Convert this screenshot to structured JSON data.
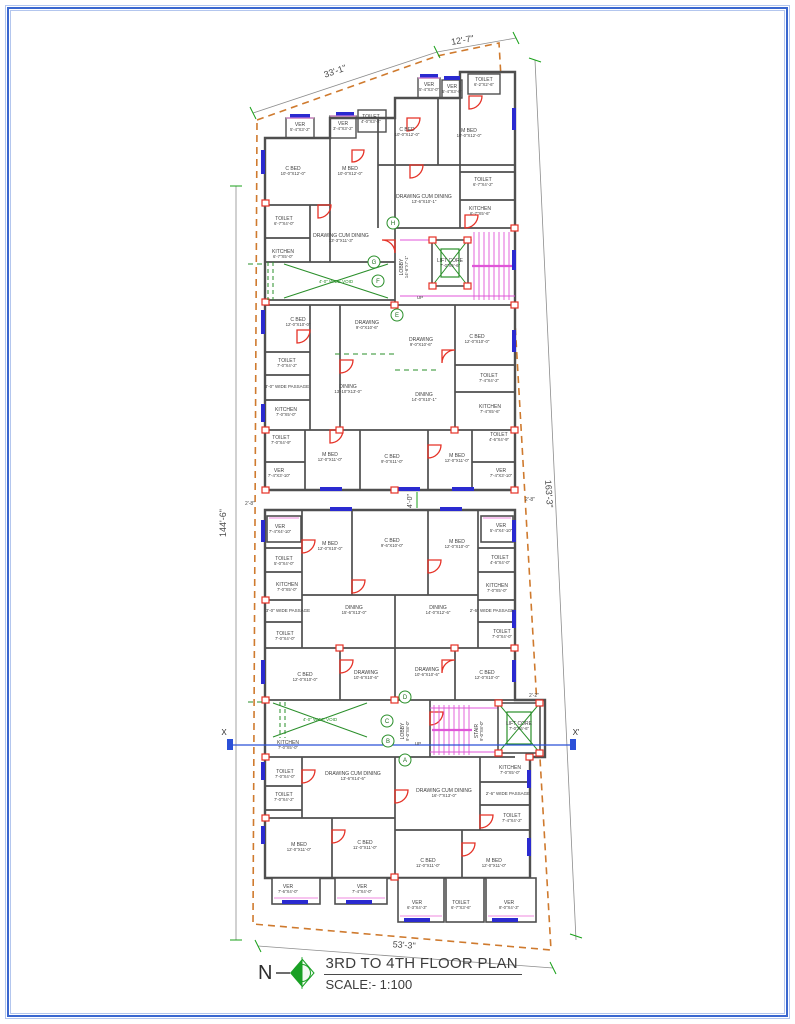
{
  "title_block": {
    "title": "3RD TO 4TH FLOOR PLAN",
    "scale": "SCALE:- 1:100",
    "north_label": "N"
  },
  "section_line": {
    "left_label": "X",
    "right_label": "X'"
  },
  "colors": {
    "border_blue": "#3a67cf",
    "wall_gray": "#4f4f4f",
    "door_red": "#e53126",
    "window_blue": "#2a2ad0",
    "dimension_green": "#18a018",
    "plot_boundary_orange": "#cf7a2e",
    "stair_magenta": "#e055d8",
    "section_blue": "#2b50d8"
  },
  "dim_labels": [
    {
      "label": "33'-1\"",
      "x": 336,
      "y": 74,
      "rot": -19,
      "size": 9
    },
    {
      "label": "12'-7\"",
      "x": 463,
      "y": 43,
      "rot": -10,
      "size": 9
    },
    {
      "label": "144'-6\"",
      "x": 226,
      "y": 523,
      "rot": -90,
      "size": 9
    },
    {
      "label": "163'-3\"",
      "x": 546,
      "y": 494,
      "rot": 86,
      "size": 9
    },
    {
      "label": "53'-3\"",
      "x": 404,
      "y": 948,
      "rot": 4,
      "size": 9
    },
    {
      "label": "4'-0\"",
      "x": 412,
      "y": 501,
      "rot": -90,
      "size": 7
    },
    {
      "label": "2'-8\"",
      "x": 250,
      "y": 505,
      "rot": 0,
      "size": 5
    },
    {
      "label": "2'-8\"",
      "x": 530,
      "y": 501,
      "rot": 0,
      "size": 5
    },
    {
      "label": "2'-2\"",
      "x": 534,
      "y": 697,
      "rot": 0,
      "size": 5
    }
  ],
  "grid_bubbles": [
    {
      "label": "H",
      "x": 393,
      "y": 223
    },
    {
      "label": "G",
      "x": 374,
      "y": 262
    },
    {
      "label": "F",
      "x": 378,
      "y": 281
    },
    {
      "label": "E",
      "x": 397,
      "y": 315
    },
    {
      "label": "D",
      "x": 405,
      "y": 697
    },
    {
      "label": "C",
      "x": 387,
      "y": 721
    },
    {
      "label": "B",
      "x": 388,
      "y": 741
    },
    {
      "label": "A",
      "x": 405,
      "y": 760
    }
  ],
  "rooms": [
    {
      "label": "VER",
      "dims": "5'-4\"X3'-2\"",
      "x": 300,
      "y": 126
    },
    {
      "label": "VER",
      "dims": "3'-4\"X3'-2\"",
      "x": 343,
      "y": 125
    },
    {
      "label": "TOILET",
      "dims": "4'-0\"X3'-2\"",
      "x": 371,
      "y": 118
    },
    {
      "label": "VER",
      "dims": "5'-4\"X3'-0\"",
      "x": 429,
      "y": 86
    },
    {
      "label": "VER",
      "dims": "5'-4\"X3'-0\"",
      "x": 452,
      "y": 88
    },
    {
      "label": "TOILET",
      "dims": "6'-2\"X2'-6\"",
      "x": 484,
      "y": 81
    },
    {
      "label": "C BED",
      "dims": "10'-0\"X12'-0\"",
      "x": 293,
      "y": 170
    },
    {
      "label": "M BED",
      "dims": "10'-0\"X12'-0\"",
      "x": 350,
      "y": 170
    },
    {
      "label": "C BED",
      "dims": "10'-0\"X12'-0\"",
      "x": 407,
      "y": 131
    },
    {
      "label": "M BED",
      "dims": "10'-0\"X12'-0\"",
      "x": 469,
      "y": 132
    },
    {
      "label": "DRAWING CUM DINING",
      "dims": "13'-6\"X10'-1\"",
      "x": 424,
      "y": 198
    },
    {
      "label": "TOILET",
      "dims": "6'-7\"X4'-2\"",
      "x": 483,
      "y": 181
    },
    {
      "label": "KITCHEN",
      "dims": "6'-7\"X5'-6\"",
      "x": 480,
      "y": 210
    },
    {
      "label": "TOILET",
      "dims": "6'-7\"X4'-0\"",
      "x": 284,
      "y": 220
    },
    {
      "label": "DRAWING CUM DINING",
      "dims": "13'-3\"X11'-3\"",
      "x": 341,
      "y": 237
    },
    {
      "label": "KITCHEN",
      "dims": "6'-7\"X5'-0\"",
      "x": 283,
      "y": 253
    },
    {
      "label": "4'-0\" WIDE VOID",
      "x": 336,
      "y": 283,
      "color": "#2a8f2a",
      "size": 4.5
    },
    {
      "label": "LOBBY",
      "dims": "14'-6\"X7'-1\"",
      "x": 403,
      "y": 267,
      "rot": -90
    },
    {
      "label": "LIFT CORE",
      "dims": "7'-0\"X6'-6\"",
      "x": 450,
      "y": 262
    },
    {
      "label": "UP",
      "x": 420,
      "y": 299,
      "size": 4.5
    },
    {
      "label": "C BED",
      "dims": "12'-0\"X10'-0\"",
      "x": 298,
      "y": 321
    },
    {
      "label": "DRAWING",
      "dims": "9'-0\"X10'-6\"",
      "x": 367,
      "y": 324
    },
    {
      "label": "DRAWING",
      "dims": "9'-0\"X10'-6\"",
      "x": 421,
      "y": 341
    },
    {
      "label": "C BED",
      "dims": "12'-0\"X10'-0\"",
      "x": 477,
      "y": 338
    },
    {
      "label": "TOILET",
      "dims": "7'-0\"X4'-2\"",
      "x": 287,
      "y": 362
    },
    {
      "label": "3'-0\" WIDE PASSAGE",
      "x": 287,
      "y": 388,
      "size": 4.5
    },
    {
      "label": "DINING",
      "dims": "13'-10\"X13'-0\"",
      "x": 348,
      "y": 388
    },
    {
      "label": "DINING",
      "dims": "14'-0\"X10'-1\"",
      "x": 424,
      "y": 396
    },
    {
      "label": "TOILET",
      "dims": "7'-4\"X4'-2\"",
      "x": 489,
      "y": 377
    },
    {
      "label": "KITCHEN",
      "dims": "7'-0\"X5'-0\"",
      "x": 286,
      "y": 411
    },
    {
      "label": "KITCHEN",
      "dims": "7'-4\"X5'-6\"",
      "x": 490,
      "y": 408
    },
    {
      "label": "TOILET",
      "dims": "7'-0\"X4'-9\"",
      "x": 281,
      "y": 439
    },
    {
      "label": "TOILET",
      "dims": "4'-6\"X4'-9\"",
      "x": 499,
      "y": 436
    },
    {
      "label": "M BED",
      "dims": "12'-0\"X11'-0\"",
      "x": 330,
      "y": 456
    },
    {
      "label": "C BED",
      "dims": "9'-0\"X11'-0\"",
      "x": 392,
      "y": 458
    },
    {
      "label": "M BED",
      "dims": "12'-0\"X11'-0\"",
      "x": 457,
      "y": 457
    },
    {
      "label": "VER",
      "dims": "7'-4\"X3'-10\"",
      "x": 279,
      "y": 472
    },
    {
      "label": "VER",
      "dims": "7'-4\"X3'-10\"",
      "x": 501,
      "y": 472
    },
    {
      "label": "VER",
      "dims": "7'-4\"X4'-10\"",
      "x": 280,
      "y": 528
    },
    {
      "label": "M BED",
      "dims": "12'-0\"X10'-0\"",
      "x": 330,
      "y": 545
    },
    {
      "label": "C BED",
      "dims": "9'-6\"X10'-0\"",
      "x": 392,
      "y": 542
    },
    {
      "label": "M BED",
      "dims": "12'-0\"X10'-0\"",
      "x": 457,
      "y": 543
    },
    {
      "label": "VER",
      "dims": "5'-4\"X4'-10\"",
      "x": 501,
      "y": 527
    },
    {
      "label": "TOILET",
      "dims": "5'-0\"X4'-0\"",
      "x": 284,
      "y": 560
    },
    {
      "label": "TOILET",
      "dims": "4'-6\"X4'-0\"",
      "x": 500,
      "y": 559
    },
    {
      "label": "KITCHEN",
      "dims": "7'-0\"X5'-0\"",
      "x": 287,
      "y": 586
    },
    {
      "label": "KITCHEN",
      "dims": "7'-0\"X5'-0\"",
      "x": 497,
      "y": 587
    },
    {
      "label": "3'-0\" WIDE PASSAGE",
      "x": 288,
      "y": 612,
      "size": 4.5
    },
    {
      "label": "DINING",
      "dims": "15'-6\"X13'-0\"",
      "x": 354,
      "y": 609
    },
    {
      "label": "DINING",
      "dims": "14'-0\"X12'-6\"",
      "x": 438,
      "y": 609
    },
    {
      "label": "2'-6\" WIDE PASSAGE",
      "x": 492,
      "y": 612,
      "size": 4.5
    },
    {
      "label": "TOILET",
      "dims": "7'-0\"X4'-0\"",
      "x": 285,
      "y": 635
    },
    {
      "label": "TOILET",
      "dims": "7'-0\"X4'-0\"",
      "x": 502,
      "y": 633
    },
    {
      "label": "C BED",
      "dims": "12'-0\"X10'-0\"",
      "x": 305,
      "y": 676
    },
    {
      "label": "DRAWING",
      "dims": "10'-6\"X10'-6\"",
      "x": 366,
      "y": 674
    },
    {
      "label": "DRAWING",
      "dims": "10'-6\"X10'-6\"",
      "x": 427,
      "y": 671
    },
    {
      "label": "C BED",
      "dims": "12'-0\"X10'-0\"",
      "x": 487,
      "y": 674
    },
    {
      "label": "4'-0\" WIDE VOID",
      "x": 320,
      "y": 721,
      "color": "#2a8f2a",
      "size": 4.5
    },
    {
      "label": "LOBBY",
      "dims": "9'-0\"X8'-0\"",
      "x": 404,
      "y": 731,
      "rot": -90
    },
    {
      "label": "STAIR",
      "dims": "9'-0\"X8'-0\"",
      "x": 478,
      "y": 731,
      "rot": -90
    },
    {
      "label": "LIFT CORE",
      "dims": "7'-0\"X6'-6\"",
      "x": 519,
      "y": 725
    },
    {
      "label": "UP",
      "x": 418,
      "y": 745,
      "size": 4.5
    },
    {
      "label": "KITCHEN",
      "dims": "7'-0\"X5'-0\"",
      "x": 288,
      "y": 744
    },
    {
      "label": "TOILET",
      "dims": "7'-0\"X4'-0\"",
      "x": 285,
      "y": 773
    },
    {
      "label": "TOILET",
      "dims": "7'-0\"X4'-2\"",
      "x": 284,
      "y": 796
    },
    {
      "label": "DRAWING CUM DINING",
      "dims": "13'-6\"X14'-6\"",
      "x": 353,
      "y": 775
    },
    {
      "label": "DRAWING CUM DINING",
      "dims": "16'-7\"X13'-0\"",
      "x": 444,
      "y": 792
    },
    {
      "label": "KITCHEN",
      "dims": "7'-0\"X5'-0\"",
      "x": 510,
      "y": 769
    },
    {
      "label": "2'-6\" WIDE PASSAGE",
      "x": 508,
      "y": 795,
      "size": 4.5
    },
    {
      "label": "TOILET",
      "dims": "7'-4\"X4'-2\"",
      "x": 512,
      "y": 817
    },
    {
      "label": "M BED",
      "dims": "12'-0\"X11'-0\"",
      "x": 299,
      "y": 846
    },
    {
      "label": "C BED",
      "dims": "11'-0\"X11'-0\"",
      "x": 365,
      "y": 844
    },
    {
      "label": "C BED",
      "dims": "11'-0\"X11'-0\"",
      "x": 428,
      "y": 862
    },
    {
      "label": "M BED",
      "dims": "12'-0\"X11'-0\"",
      "x": 494,
      "y": 862
    },
    {
      "label": "VER",
      "dims": "7'-6\"X4'-0\"",
      "x": 288,
      "y": 888
    },
    {
      "label": "VER",
      "dims": "7'-4\"X4'-0\"",
      "x": 362,
      "y": 888
    },
    {
      "label": "VER",
      "dims": "6'-3\"X4'-3\"",
      "x": 417,
      "y": 904
    },
    {
      "label": "TOILET",
      "dims": "6'-7\"X3'-6\"",
      "x": 461,
      "y": 904
    },
    {
      "label": "VER",
      "dims": "8'-0\"X4'-3\"",
      "x": 509,
      "y": 904
    }
  ]
}
